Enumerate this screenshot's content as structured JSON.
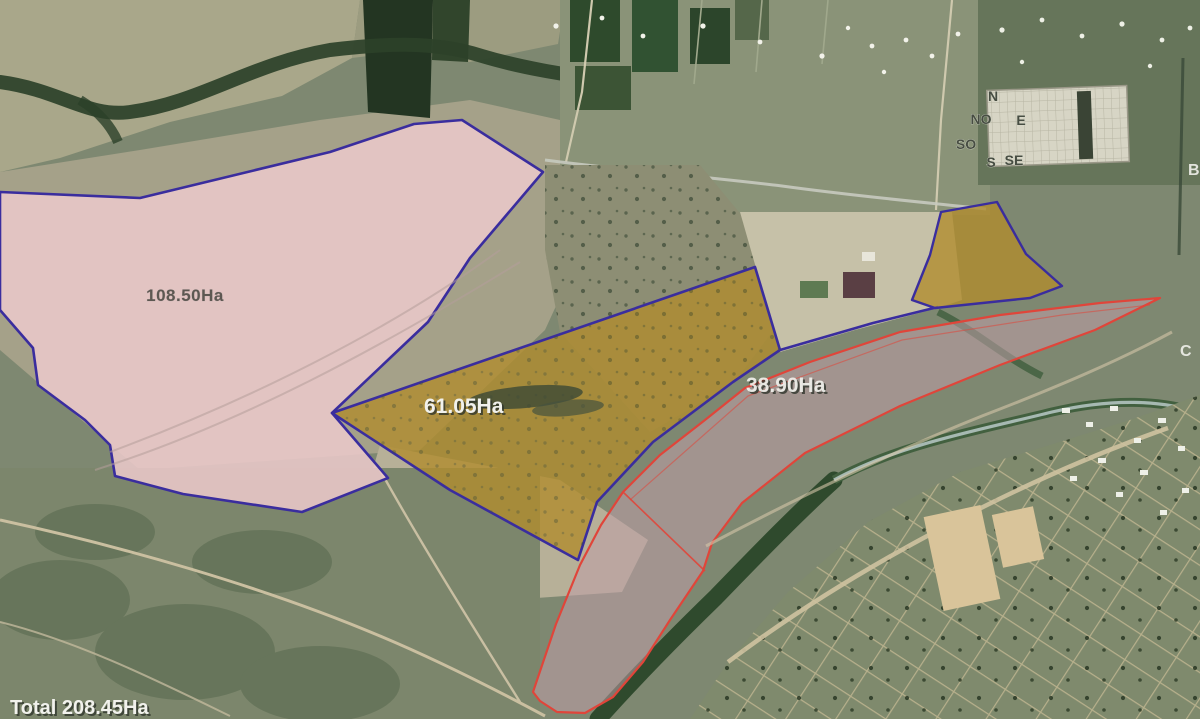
{
  "map": {
    "type": "satellite-parcel-map",
    "parcels": [
      {
        "id": "parcel-1",
        "area_label": "108.50Ha",
        "outline": "blue",
        "fill": "pink"
      },
      {
        "id": "parcel-2",
        "area_label": "61.05Ha",
        "outline": "blue",
        "fill": "gold"
      },
      {
        "id": "parcel-3",
        "area_label": "38.90Ha",
        "outline": "red",
        "fill": "mauve"
      }
    ],
    "total_label": "Total 208.45Ha",
    "compass": {
      "n": "N",
      "no": "NO",
      "e": "E",
      "so": "SO",
      "s": "S",
      "se": "SE"
    },
    "edge_letters": {
      "b": "B",
      "c": "C"
    },
    "colors": {
      "parcel_blue_outline": "#3a2d9e",
      "parcel_red_outline": "#e0453a",
      "parcel1_fill": "#ebc8ca",
      "parcel2_fill": "#b08c2e",
      "parcel3_fill": "#c09fa8",
      "terrain_base": "#7e8871",
      "pale_field": "#a9a78a",
      "dark_trees": "#2c4129"
    }
  }
}
